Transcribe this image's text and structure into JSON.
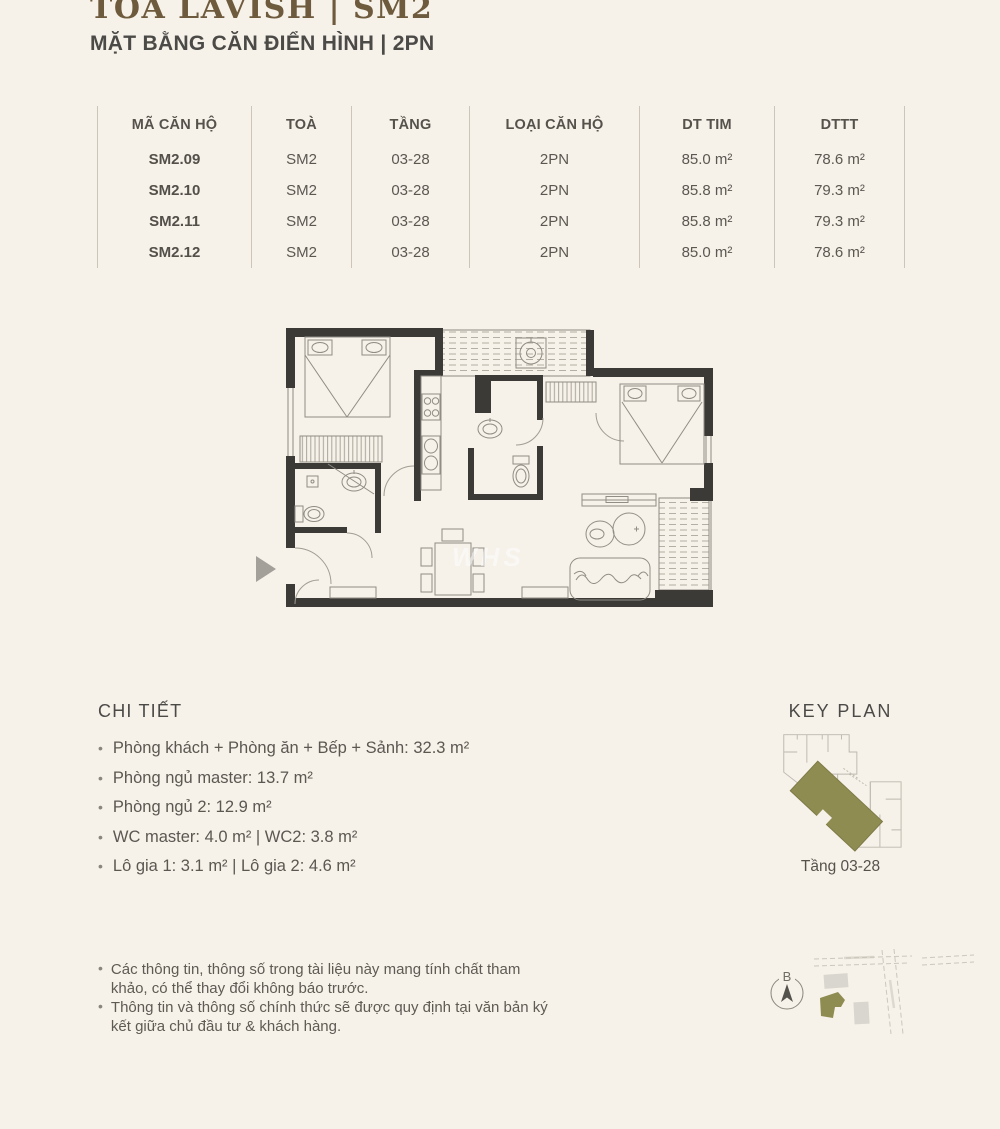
{
  "ui": {
    "bullet": "•"
  },
  "header": {
    "title": "TOÀ LAVISH | SM2",
    "subtitle": "MẶT BẰNG CĂN ĐIỂN HÌNH | 2PN"
  },
  "units_table": {
    "headers": [
      "MÃ CĂN HỘ",
      "TOÀ",
      "TẦNG",
      "LOẠI CĂN HỘ",
      "DT TIM",
      "DTTT"
    ],
    "rows": [
      [
        "SM2.09",
        "SM2",
        "03-28",
        "2PN",
        "85.0 m²",
        "78.6 m²"
      ],
      [
        "SM2.10",
        "SM2",
        "03-28",
        "2PN",
        "85.8 m²",
        "79.3 m²"
      ],
      [
        "SM2.11",
        "SM2",
        "03-28",
        "2PN",
        "85.8 m²",
        "79.3 m²"
      ],
      [
        "SM2.12",
        "SM2",
        "03-28",
        "2PN",
        "85.0 m²",
        "78.6 m²"
      ]
    ]
  },
  "details": {
    "heading": "CHI TIẾT",
    "items": [
      "Phòng khách + Phòng ăn + Bếp + Sảnh: 32.3 m²",
      "Phòng ngủ master: 13.7 m²",
      "Phòng ngủ 2: 12.9 m²",
      "WC master: 4.0 m² | WC2: 3.8 m²",
      "Lô gia 1: 3.1 m² | Lô gia 2: 4.6 m²"
    ]
  },
  "keyplan": {
    "heading": "KEY PLAN",
    "caption": "Tầng 03-28"
  },
  "compass": {
    "label": "B"
  },
  "plan": {
    "watermark": "WHS"
  },
  "notes": [
    "Các thông tin, thông số trong tài liệu này mang tính chất tham khảo, có thể thay đổi không báo trước.",
    "Thông tin và thông số chính thức sẽ được quy định tại văn bản ký kết giữa chủ đầu tư & khách hàng."
  ],
  "colors": {
    "background": "#f6f1e9",
    "title_brown": "#6e5a3c",
    "heading_dark": "#4b4a47",
    "wall_dark": "#3c3a37",
    "olive_highlight": "#8f8c52"
  }
}
